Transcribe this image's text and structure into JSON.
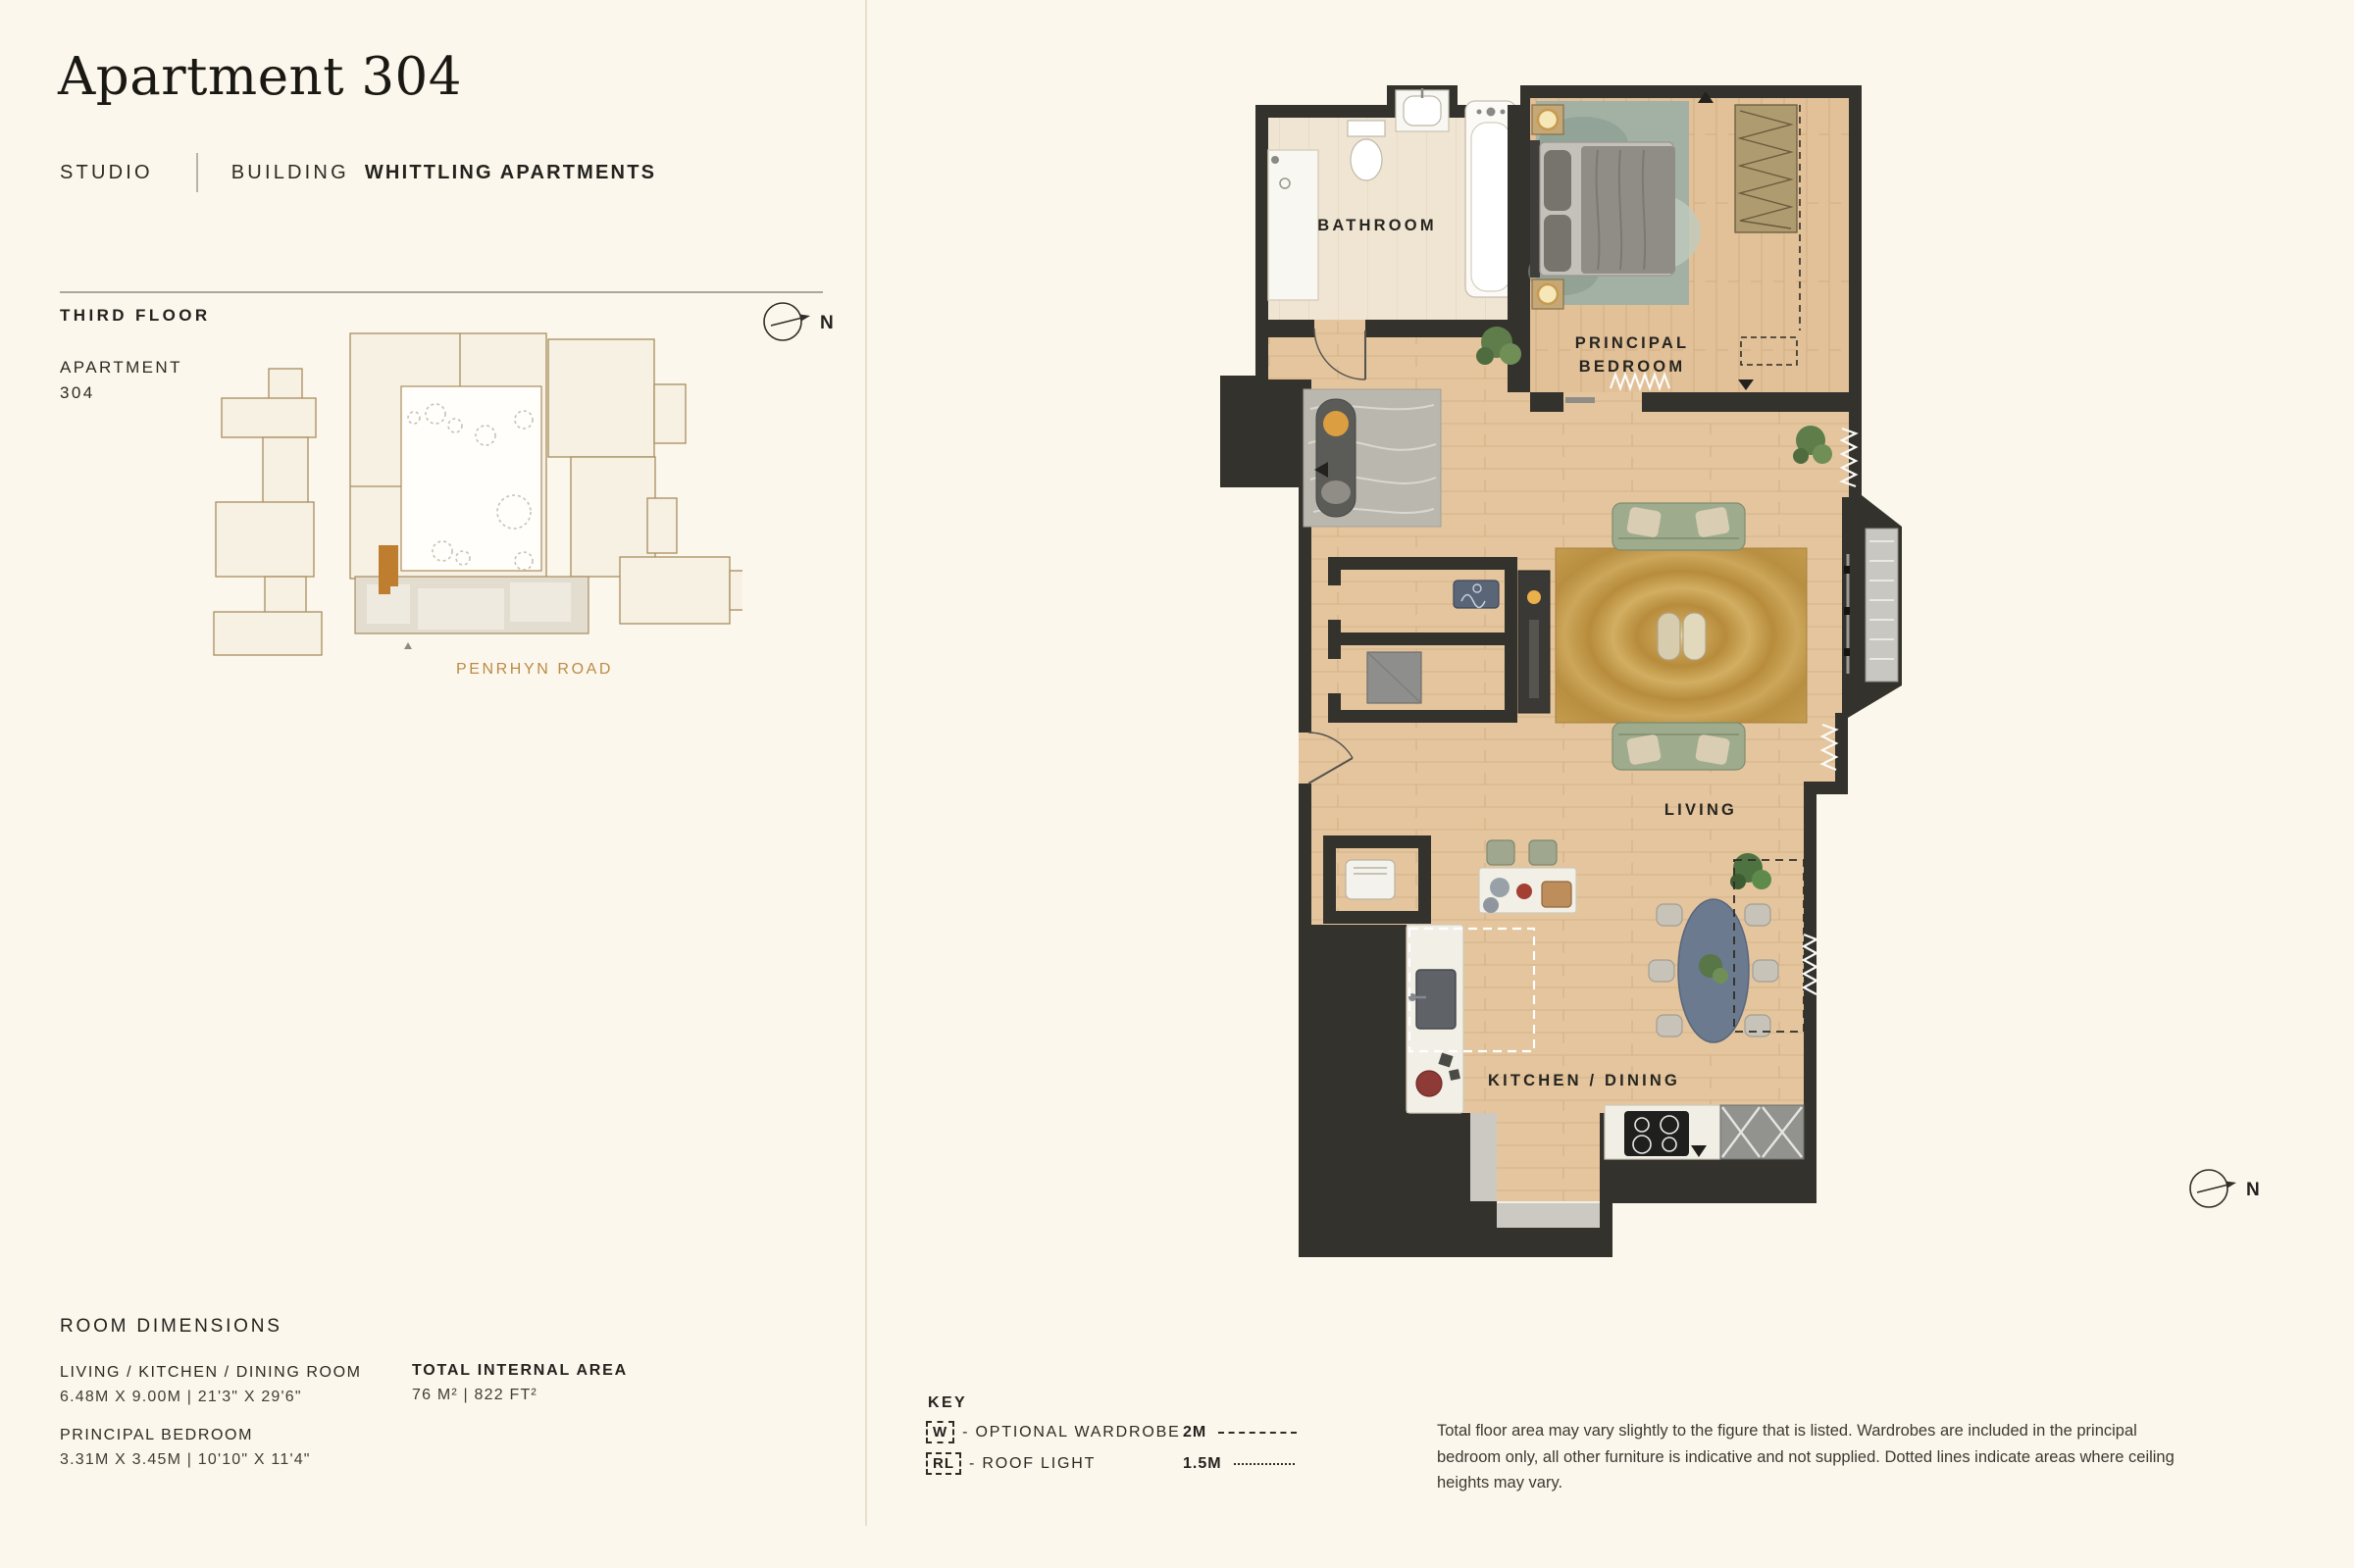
{
  "header": {
    "title": "Apartment 304",
    "unit_type": "STUDIO",
    "building_label": "BUILDING",
    "building_name": "WHITTLING APARTMENTS"
  },
  "key_plan": {
    "floor_label": "THIRD FLOOR",
    "apartment_label": "APARTMENT",
    "apartment_number": "304",
    "street_label": "PENRHYN ROAD",
    "north_label": "N",
    "highlight_color": "#BE7D2F"
  },
  "floor_plan": {
    "north_label": "N",
    "rooms": {
      "bathroom": "BATHROOM",
      "principal_bedroom_line1": "PRINCIPAL",
      "principal_bedroom_line2": "BEDROOM",
      "living": "LIVING",
      "kitchen_dining": "KITCHEN / DINING"
    }
  },
  "room_dimensions": {
    "heading": "ROOM DIMENSIONS",
    "rooms": [
      {
        "name": "LIVING / KITCHEN / DINING ROOM",
        "dims": "6.48M X 9.00M | 21'3\" X 29'6\""
      },
      {
        "name": "PRINCIPAL BEDROOM",
        "dims": "3.31M X 3.45M | 10'10\" X 11'4\""
      }
    ],
    "total": {
      "heading": "TOTAL INTERNAL AREA",
      "value": "76 M² | 822 FT²"
    }
  },
  "legend": {
    "heading": "KEY",
    "items": [
      {
        "symbol": "W",
        "label": "- OPTIONAL WARDROBE"
      },
      {
        "symbol": "RL",
        "label": "- ROOF LIGHT"
      }
    ],
    "scales": [
      {
        "label": "2M",
        "style": "dashed"
      },
      {
        "label": "1.5M",
        "style": "dotted"
      }
    ]
  },
  "disclaimer": "Total floor area may vary slightly to the figure that is listed. Wardrobes are included in the principal bedroom only, all other furniture is indicative and not supplied. Dotted lines indicate areas where ceiling heights may vary.",
  "colors": {
    "background": "#FBF7EC",
    "wall": "#34322C",
    "wood_floor": "#E4C59E",
    "highlight_unit": "#BE7D2F",
    "street_text": "#BD8A45"
  }
}
